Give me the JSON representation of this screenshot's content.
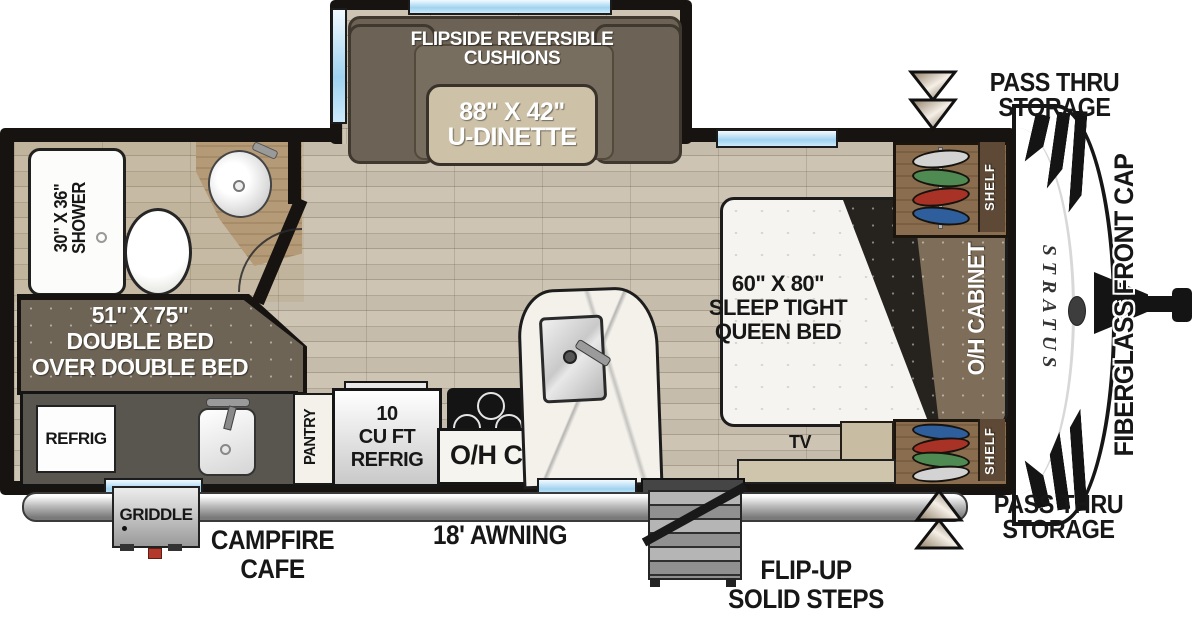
{
  "floorplan": {
    "brand": "STRATUS",
    "front_cap_label": "FIBERGLASS FRONT CAP",
    "pass_thru_top": {
      "line1": "PASS THRU",
      "line2": "STORAGE"
    },
    "pass_thru_bottom": {
      "line1": "PASS THRU",
      "line2": "STORAGE"
    },
    "awning_label": "18' AWNING",
    "griddle_label": "GRIDDLE",
    "campfire": {
      "line1": "CAMPFIRE",
      "line2": "CAFE"
    },
    "steps_label": {
      "line1": "FLIP-UP",
      "line2": "SOLID STEPS"
    },
    "slideout": {
      "cushions_line1": "FLIPSIDE REVERSIBLE",
      "cushions_line2": "CUSHIONS",
      "table_size": "88\" X 42\"",
      "table_name": "U-DINETTE"
    },
    "bathroom": {
      "shower_size": "30\" X 36\"",
      "shower_name": "SHOWER"
    },
    "bunk": {
      "line1": "51\" X 75\"",
      "line2": "DOUBLE BED",
      "line3": "OVER DOUBLE BED"
    },
    "kitchen": {
      "refrig_label": "REFRIG",
      "pantry_label": "PANTRY",
      "fridge_line1": "10",
      "fridge_line2": "CU FT",
      "fridge_line3": "REFRIG",
      "oh_cabinet_label": "O/H CABINET"
    },
    "bedroom": {
      "bed_line1": "60\" X 80\"",
      "bed_line2": "SLEEP TIGHT",
      "bed_line3": "QUEEN BED",
      "oh_cabinet_label": "O/H CABINET",
      "tv_label": "TV",
      "shelf_top": "SHELF",
      "shelf_bottom": "SHELF"
    },
    "colors": {
      "wall": "#161310",
      "window_blue": "#9fd2f0",
      "sofa_taupe": "#6c6356",
      "bunk_taupe": "#6e6455",
      "wood_cabinet": "#8a6d4e",
      "floor_tan": "#c9c0af",
      "accent_red": "#a93226",
      "accent_green": "#4e8a52",
      "accent_blue": "#2e5e9c"
    }
  }
}
